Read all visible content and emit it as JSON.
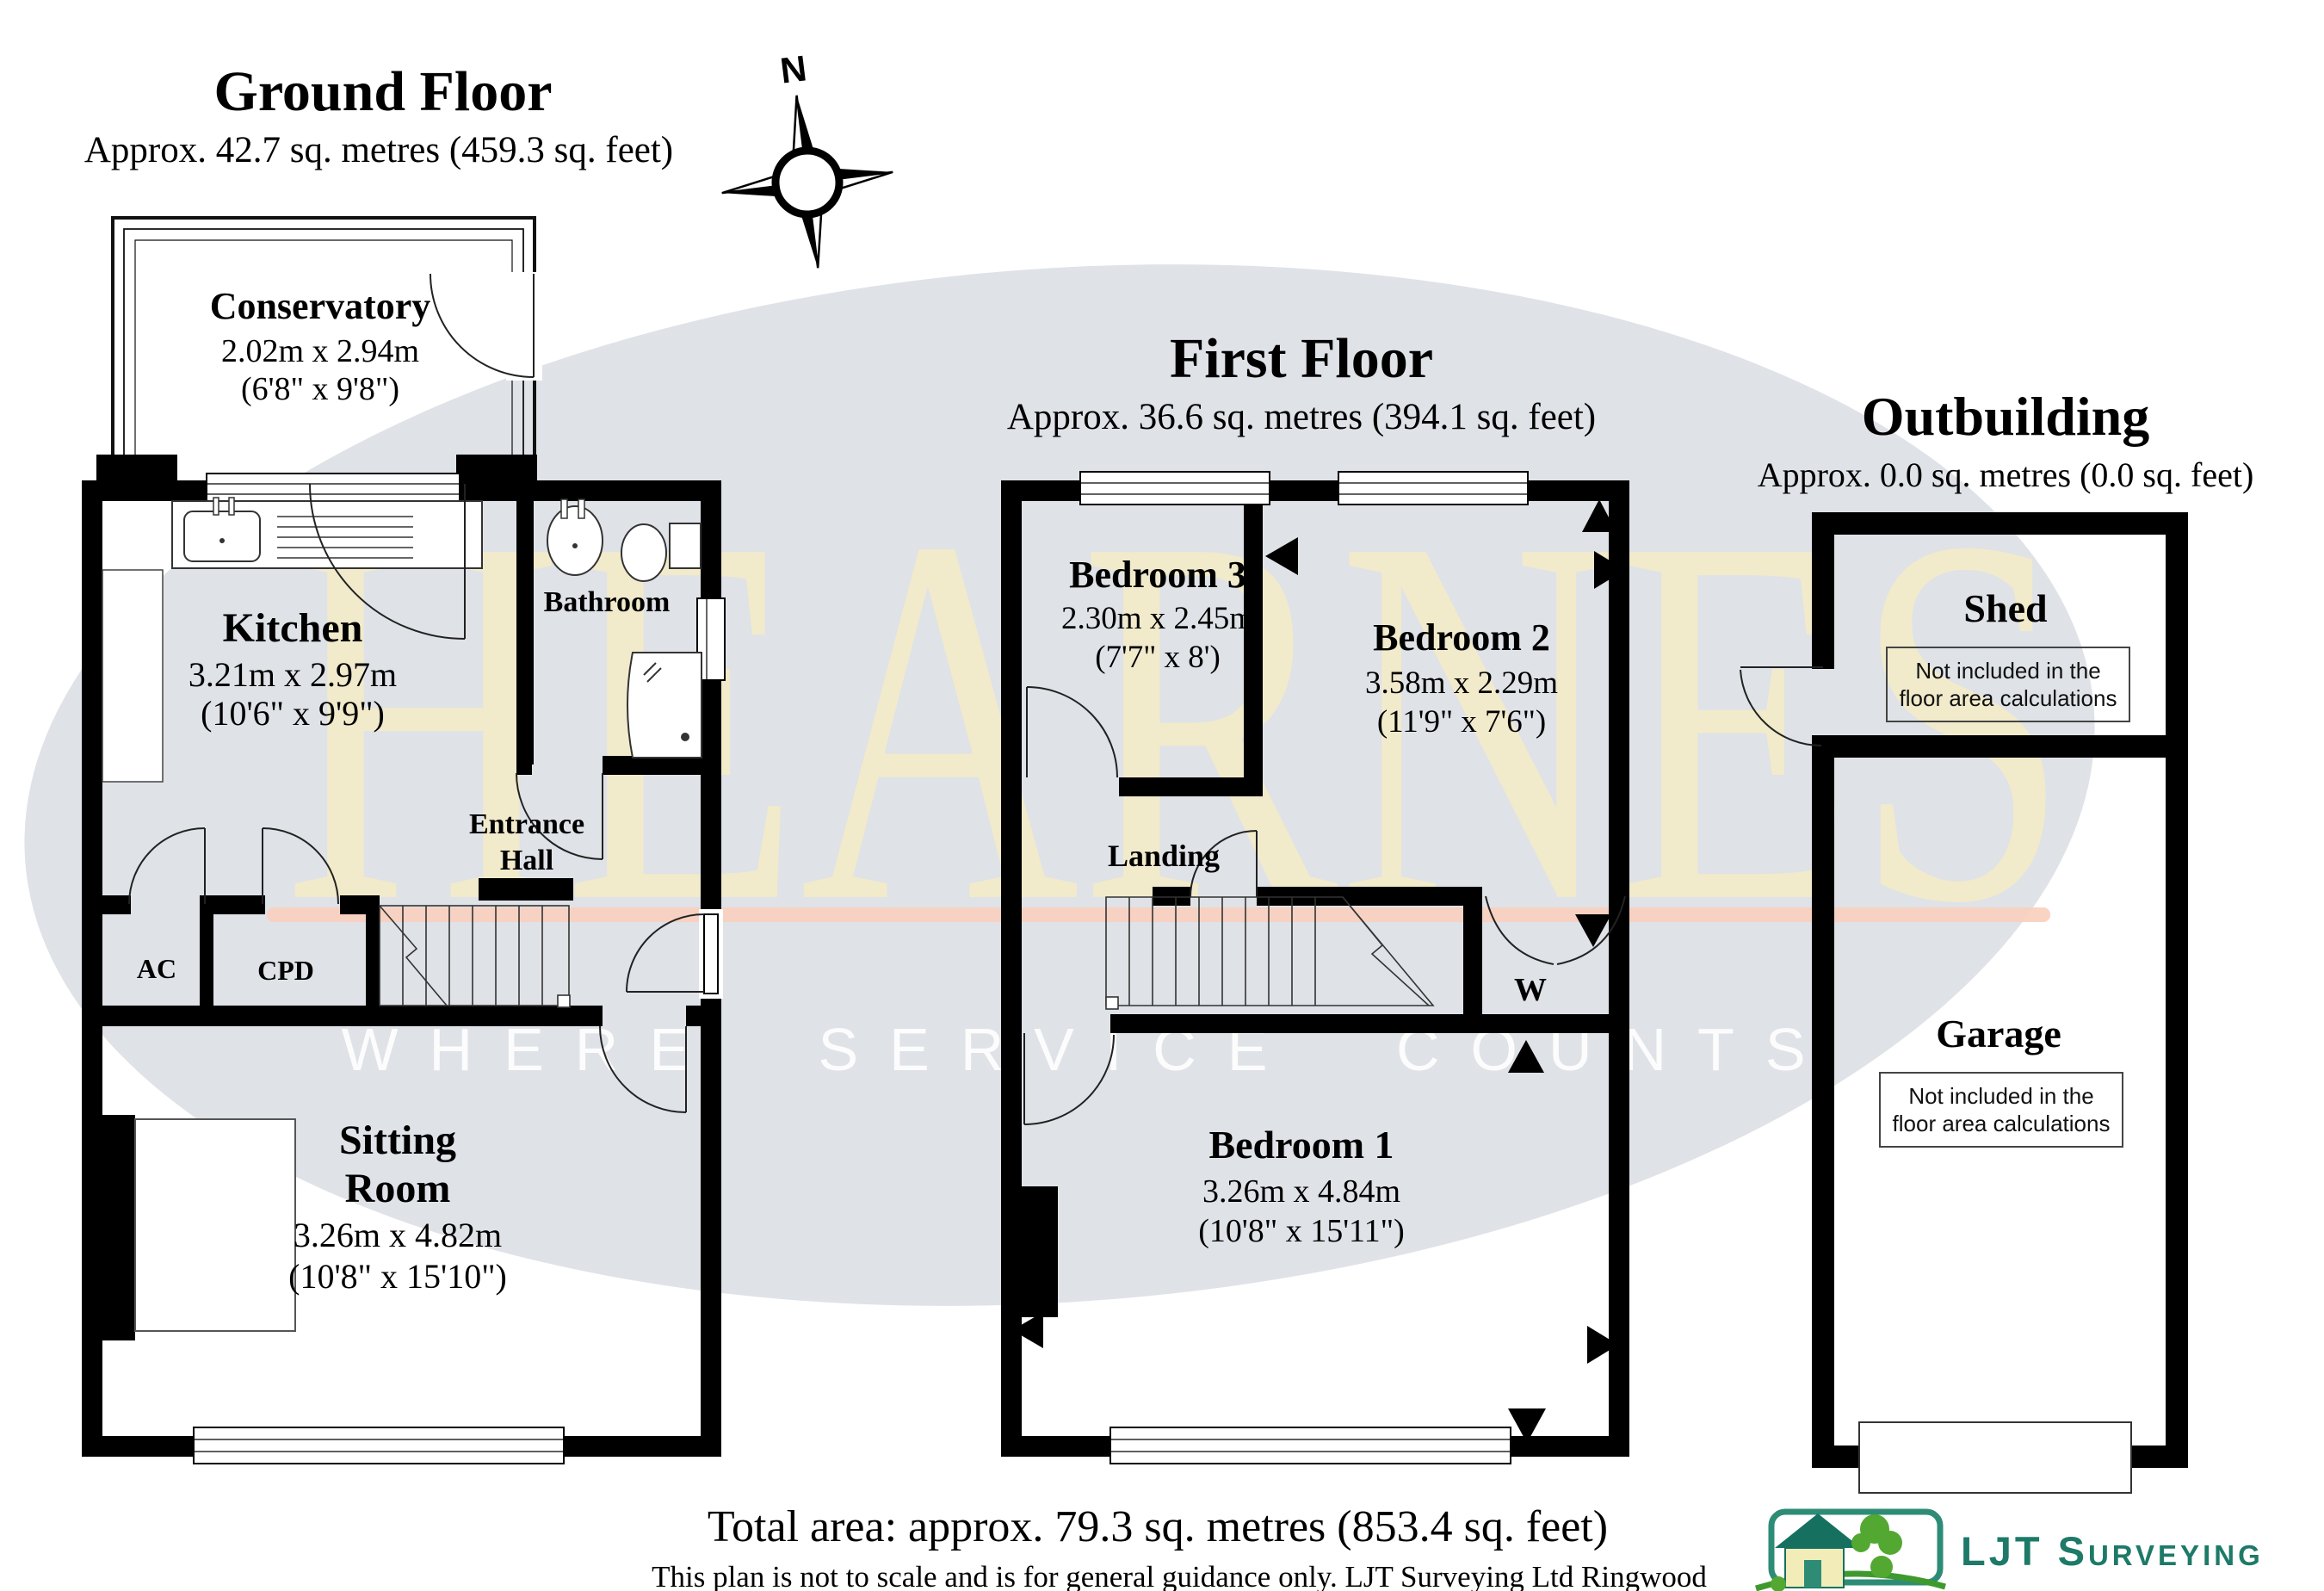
{
  "watermark": {
    "name": "HEARNES",
    "tagline": "WHERE SERVICE COUNTS"
  },
  "compass": {
    "north_label": "N"
  },
  "colors": {
    "ellipse": "#dfe2e7",
    "watermark_text": "#f6ecc5",
    "tagline_text": "#ffffff",
    "accent_line": "#f9cfbc",
    "wall": "#000000",
    "logo_teal": "#1d7a68",
    "logo_green": "#53a832"
  },
  "ground_floor": {
    "title": "Ground Floor",
    "subtitle": "Approx. 42.7 sq. metres (459.3 sq. feet)",
    "rooms": {
      "conservatory": {
        "name": "Conservatory",
        "metric": "2.02m x 2.94m",
        "imperial": "(6'8\" x 9'8\")"
      },
      "kitchen": {
        "name": "Kitchen",
        "metric": "3.21m x 2.97m",
        "imperial": "(10'6\" x 9'9\")"
      },
      "bathroom": {
        "name": "Bathroom"
      },
      "entrance_hall": {
        "line1": "Entrance",
        "line2": "Hall"
      },
      "ac": {
        "name": "AC"
      },
      "cpd": {
        "name": "CPD"
      },
      "sitting_room": {
        "line1": "Sitting",
        "line2": "Room",
        "metric": "3.26m x 4.82m",
        "imperial": "(10'8\" x 15'10\")"
      }
    }
  },
  "first_floor": {
    "title": "First Floor",
    "subtitle": "Approx. 36.6 sq. metres (394.1 sq. feet)",
    "rooms": {
      "bedroom3": {
        "name": "Bedroom 3",
        "metric": "2.30m x 2.45m",
        "imperial": "(7'7\" x 8')"
      },
      "bedroom2": {
        "name": "Bedroom 2",
        "metric": "3.58m x 2.29m",
        "imperial": "(11'9\" x 7'6\")"
      },
      "landing": {
        "name": "Landing"
      },
      "wardrobe": {
        "name": "W"
      },
      "bedroom1": {
        "name": "Bedroom 1",
        "metric": "3.26m x 4.84m",
        "imperial": "(10'8\" x 15'11\")"
      }
    }
  },
  "outbuilding": {
    "title": "Outbuilding",
    "subtitle": "Approx. 0.0 sq. metres (0.0 sq. feet)",
    "rooms": {
      "shed": {
        "name": "Shed"
      },
      "garage": {
        "name": "Garage"
      }
    },
    "note": {
      "line1": "Not included in the",
      "line2": "floor area calculations"
    }
  },
  "footer": {
    "total": "Total area: approx. 79.3 sq. metres (853.4 sq. feet)",
    "disclaimer": "This plan is not to scale and is for general guidance only. LJT Surveying Ltd Ringwood",
    "logo_text": "LJT Surveying"
  }
}
